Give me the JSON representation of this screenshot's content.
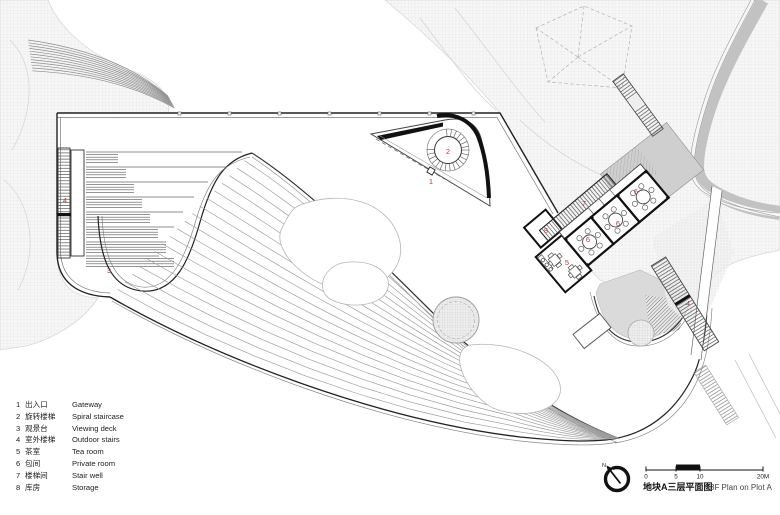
{
  "page": {
    "type": "architectural-floor-plan"
  },
  "legend": {
    "items": [
      {
        "num": "1",
        "zh": "出入口",
        "en": "Gateway"
      },
      {
        "num": "2",
        "zh": "旋转楼梯",
        "en": "Spiral staircase"
      },
      {
        "num": "3",
        "zh": "观景台",
        "en": "Viewing deck"
      },
      {
        "num": "4",
        "zh": "室外楼梯",
        "en": "Outdoor stairs"
      },
      {
        "num": "5",
        "zh": "茶室",
        "en": "Tea room"
      },
      {
        "num": "6",
        "zh": "包间",
        "en": "Private room"
      },
      {
        "num": "7",
        "zh": "楼梯间",
        "en": "Stair well"
      },
      {
        "num": "8",
        "zh": "库房",
        "en": "Storage"
      }
    ]
  },
  "plan_labels": [
    {
      "text": "4",
      "x": 65,
      "y": 203
    },
    {
      "text": "3",
      "x": 109,
      "y": 273
    },
    {
      "text": "1",
      "x": 431,
      "y": 184
    },
    {
      "text": "2",
      "x": 448,
      "y": 154
    },
    {
      "text": "7",
      "x": 584,
      "y": 206
    },
    {
      "text": "8",
      "x": 546,
      "y": 233
    },
    {
      "text": "6",
      "x": 636,
      "y": 194
    },
    {
      "text": "6",
      "x": 618,
      "y": 226
    },
    {
      "text": "6",
      "x": 588,
      "y": 242
    },
    {
      "text": "5",
      "x": 567,
      "y": 265
    },
    {
      "text": "4",
      "x": 688,
      "y": 306
    }
  ],
  "titleblock": {
    "north_label": "N",
    "scale_ticks": [
      {
        "label": "0",
        "x": 646
      },
      {
        "label": "5",
        "x": 676
      },
      {
        "label": "10",
        "x": 700
      },
      {
        "label": "20M",
        "x": 763
      }
    ],
    "title_zh": "地块A三层平面图",
    "title_en": "3F Plan on Plot A"
  },
  "colors": {
    "label_red": "#a8403c",
    "line_dark": "#222222",
    "roof_gray": "#cfcfcf",
    "road_gray": "#c2c2c2",
    "terrain_line": "#dcdcdc"
  }
}
